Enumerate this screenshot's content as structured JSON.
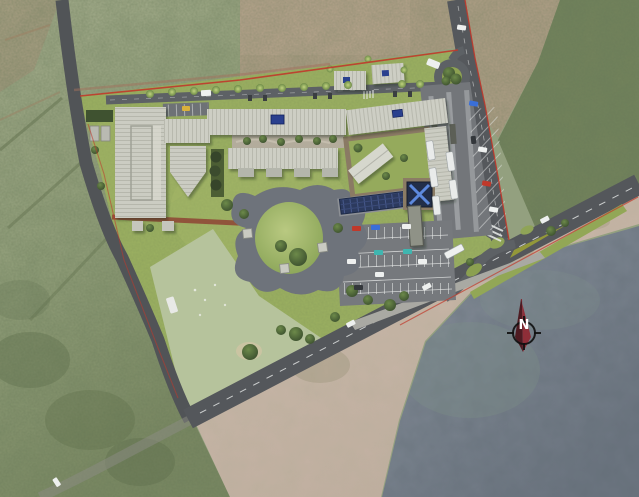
{
  "meta": {
    "title": "Coastal campus master plan - aerial site rendering",
    "image_type": "architectural site plan rendered over aerial photograph",
    "canvas": {
      "width": 639,
      "height": 497
    }
  },
  "compass": {
    "label": "N",
    "needle_dark": "#4e1b22",
    "needle_light": "#8e2e38",
    "ring": "#101010"
  },
  "palette": {
    "site_lawn": "#9cb161",
    "sports_field": "#b6c39c",
    "roof_light": "#cdcec4",
    "road_asphalt": "#56595d",
    "plaza_concrete": "#6f747c",
    "parking_asphalt": "#76797d",
    "solar_panel": "#2c3a5e",
    "skylight_blue": "#2b3f8e",
    "boundary_red": "#c0392b",
    "running_path_red": "#8f4a36",
    "beach_sand": "#c7b6a7",
    "ocean_water": "#77808a",
    "forest_green": "#74845d",
    "farmland_green": "#a8b090"
  },
  "scene": {
    "surroundings": [
      "farm-fields-northwest",
      "dirt-clearing-north",
      "forest-east",
      "coastal-scrub-southwest",
      "beach-shoreline",
      "ocean-southeast"
    ],
    "site": {
      "boundary": "red property line",
      "buildings": [
        "west-hall",
        "west-hall-wing",
        "gymnasium",
        "north-classroom-block",
        "south-classroom-block",
        "northeast-block",
        "east-wing",
        "courtyard-pavilion",
        "small-block-a",
        "small-block-b",
        "entry-tower-skylight",
        "covered-walkway",
        "shed-a",
        "shed-b"
      ],
      "features": [
        "central-plaza",
        "grass-mound",
        "sports-field",
        "solar-panel-array",
        "utility-yard",
        "running-path",
        "roundabout",
        "bus-terminal",
        "south-parking-lot",
        "roadside-sidewalk",
        "checkered-crosswalk",
        "junction-median-hatch",
        "courtyard-gardens"
      ],
      "roads": [
        "internal-loop-road",
        "north-access-road",
        "coastal-road",
        "west-rural-road",
        "faint-southwest-track"
      ],
      "vehicles": {
        "buses_in_terminal": 5,
        "bus_on_road": 1,
        "car_colors": [
          "white",
          "blue",
          "red",
          "teal",
          "yellow",
          "dark-gray"
        ]
      }
    }
  }
}
